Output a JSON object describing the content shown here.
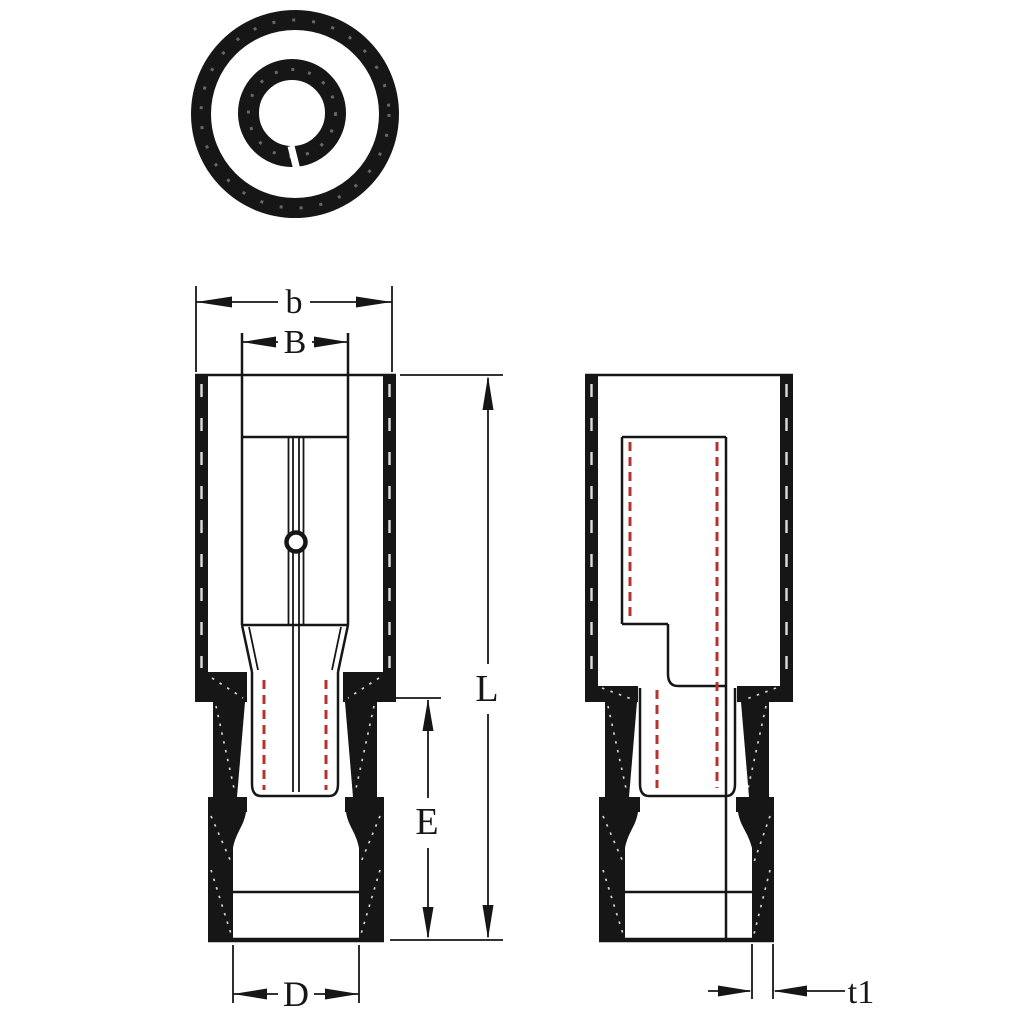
{
  "colors": {
    "line": "#161616",
    "hidden_line": "#b7322c",
    "background": "#ffffff"
  },
  "dimensions": {
    "b": {
      "label": "b"
    },
    "B": {
      "label": "B"
    },
    "L": {
      "label": "L"
    },
    "E": {
      "label": "E"
    },
    "D": {
      "label": "D"
    },
    "t1": {
      "label": "t1"
    }
  }
}
